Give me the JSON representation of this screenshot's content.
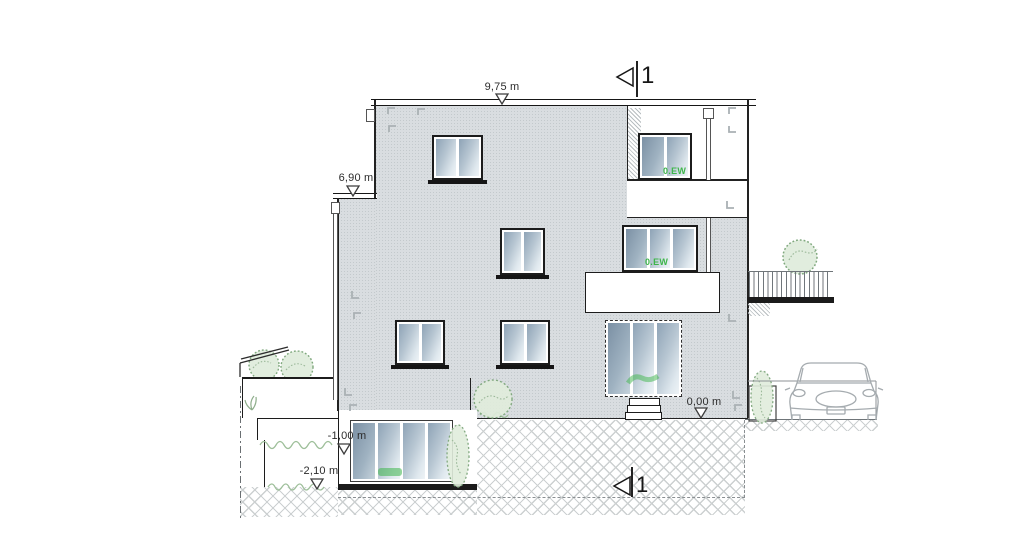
{
  "drawing": {
    "kind": "building-elevation-section",
    "levels": {
      "roof": "9,75 m",
      "left_roof": "6,90 m",
      "ground": "0,00 m",
      "basement_upper": "-1,00 m",
      "basement_lower": "-2,10 m"
    },
    "section_marker": {
      "top": "1",
      "bottom": "1"
    },
    "window_tags": {
      "loggia_door": "0.EW",
      "balcony_door": "0.EW"
    },
    "icons": [
      "level-marker-icon",
      "section-arrow-icon",
      "tree-icon",
      "bush-icon",
      "grass-icon",
      "car-icon"
    ],
    "colors": {
      "facade": "#d9dde0",
      "glass_dark": "#8ea3b6",
      "glass_light": "#eef3f6",
      "line": "#222222",
      "hatch": "#ccd0d1",
      "green_label": "#3db54a",
      "vegetation": "#7fa87d"
    }
  }
}
